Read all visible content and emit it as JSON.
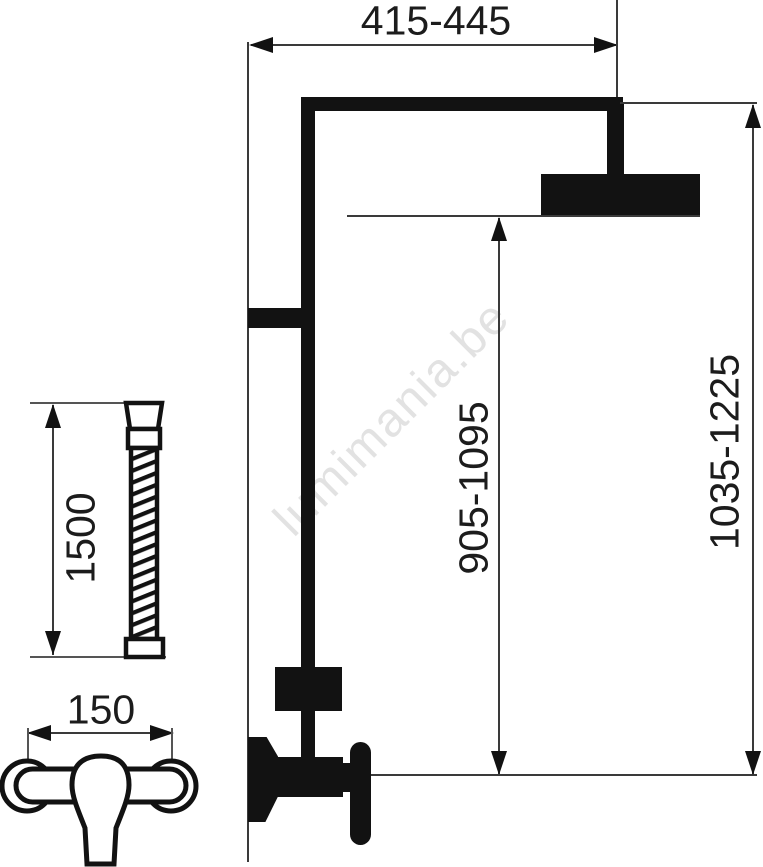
{
  "watermark": {
    "text": "lumimania.be",
    "color": "#e2e2e2"
  },
  "dimensions": {
    "rail_width": {
      "label": "415-445",
      "orientation": "horizontal"
    },
    "total_height": {
      "label": "1035-1225",
      "orientation": "vertical"
    },
    "head_height": {
      "label": "905-1095",
      "orientation": "vertical"
    },
    "hose_length": {
      "label": "1500",
      "orientation": "vertical"
    },
    "valve_centers": {
      "label": "150",
      "orientation": "horizontal"
    }
  },
  "colors": {
    "ink": "#121212",
    "dimension_line": "#3a3a3a",
    "watermark": "#e2e2e2",
    "background": "#ffffff"
  },
  "parts": {
    "shower_head": "overhead-shower-head",
    "riser": "riser-pipe",
    "hose": "shower-hose-1500mm",
    "mixer": "wall-mixer-150mm"
  }
}
